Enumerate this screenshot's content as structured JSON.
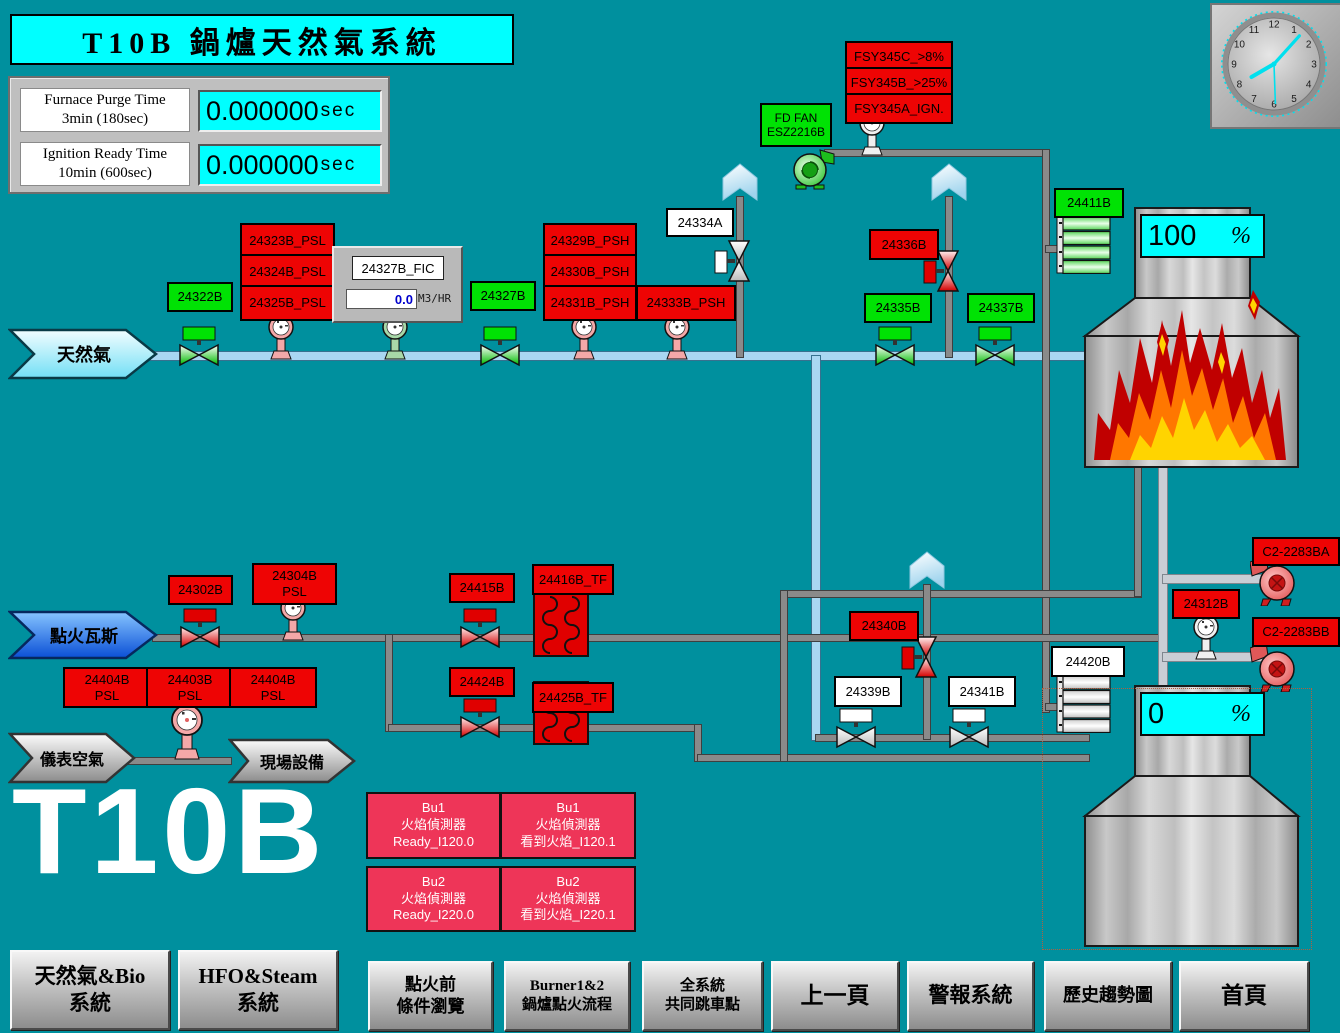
{
  "header": {
    "title": "T10B 鍋爐天然氣系統"
  },
  "clock": {
    "numbers": [
      "12",
      "1",
      "2",
      "3",
      "4",
      "5",
      "6",
      "7",
      "8",
      "9",
      "10",
      "11"
    ]
  },
  "timers": {
    "purge": {
      "line1": "Furnace Purge Time",
      "line2": "3min (180sec)",
      "value": "0.000000",
      "unit": "sec"
    },
    "ignition": {
      "line1": "Ignition Ready Time",
      "line2": "10min (600sec)",
      "value": "0.000000",
      "unit": "sec"
    }
  },
  "arrows": {
    "natural_gas": "天然氣",
    "ignition_gas": "點火瓦斯",
    "instrument_air": "儀表空氣",
    "field_equipment": "現場設備"
  },
  "tags": {
    "t24322b": "24322B",
    "t24323b": "24323B_PSL",
    "t24324b": "24324B_PSL",
    "t24325b": "24325B_PSL",
    "t24327b": "24327B",
    "t24329b": "24329B_PSH",
    "t24330b": "24330B_PSH",
    "t24331b": "24331B_PSH",
    "t24333b": "24333B_PSH",
    "t24334a": "24334A",
    "fsy_c": "FSY345C_>8%",
    "fsy_b": "FSY345B_>25%",
    "fsy_a": "FSY345A_IGN.",
    "fd_fan_line1": "FD FAN",
    "fd_fan_line2": "ESZ2216B",
    "t24336b": "24336B",
    "t24335b": "24335B",
    "t24337b": "24337B",
    "t24411b": "24411B",
    "t24302b": "24302B",
    "t24304b_line1": "24304B",
    "t24304b_line2": "PSL",
    "t24415b": "24415B",
    "t24416b": "24416B_TF",
    "t24424b": "24424B",
    "t24425b": "24425B_TF",
    "t24340b": "24340B",
    "t24339b": "24339B",
    "t24341b": "24341B",
    "t24420b": "24420B",
    "t24312b": "24312B",
    "c2_2283ba": "C2-2283BA",
    "c2_2283bb": "C2-2283BB"
  },
  "psl_row": [
    {
      "line1": "24404B",
      "line2": "PSL"
    },
    {
      "line1": "24403B",
      "line2": "PSL"
    },
    {
      "line1": "24404B",
      "line2": "PSL"
    }
  ],
  "fic": {
    "tag": "24327B_FIC",
    "value": "0.0",
    "unit": "M3/HR"
  },
  "displays": {
    "furnace_top": {
      "value": "100",
      "unit": "%"
    },
    "furnace_bottom": {
      "value": "0",
      "unit": "%"
    }
  },
  "flame_detectors": [
    {
      "burner": "Bu1",
      "device": "火焰偵測器",
      "status": "Ready_I120.0"
    },
    {
      "burner": "Bu1",
      "device": "火焰偵測器",
      "status": "看到火焰_I120.1"
    },
    {
      "burner": "Bu2",
      "device": "火焰偵測器",
      "status": "Ready_I220.0"
    },
    {
      "burner": "Bu2",
      "device": "火焰偵測器",
      "status": "看到火焰_I220.1"
    }
  ],
  "watermark": "T10B",
  "nav": [
    {
      "line1": "天然氣&Bio",
      "line2": "系統"
    },
    {
      "line1": "HFO&Steam",
      "line2": "系統"
    },
    {
      "line1": "點火前",
      "line2": "條件瀏覽"
    },
    {
      "line1": "Burner1&2",
      "line2": "鍋爐點火流程"
    },
    {
      "line1": "全系統",
      "line2": "共同跳車點"
    },
    {
      "line1": "上一頁",
      "line2": ""
    },
    {
      "line1": "警報系統",
      "line2": ""
    },
    {
      "line1": "歷史趨勢圖",
      "line2": ""
    },
    {
      "line1": "首頁",
      "line2": ""
    }
  ],
  "colors": {
    "background": "#00909E",
    "alarm_red": "#EE0404",
    "ok_green": "#00E204",
    "display_cyan": "#00FFFF",
    "detector_pink": "#EE3558",
    "pipe_blue": "#A9D7F2"
  }
}
